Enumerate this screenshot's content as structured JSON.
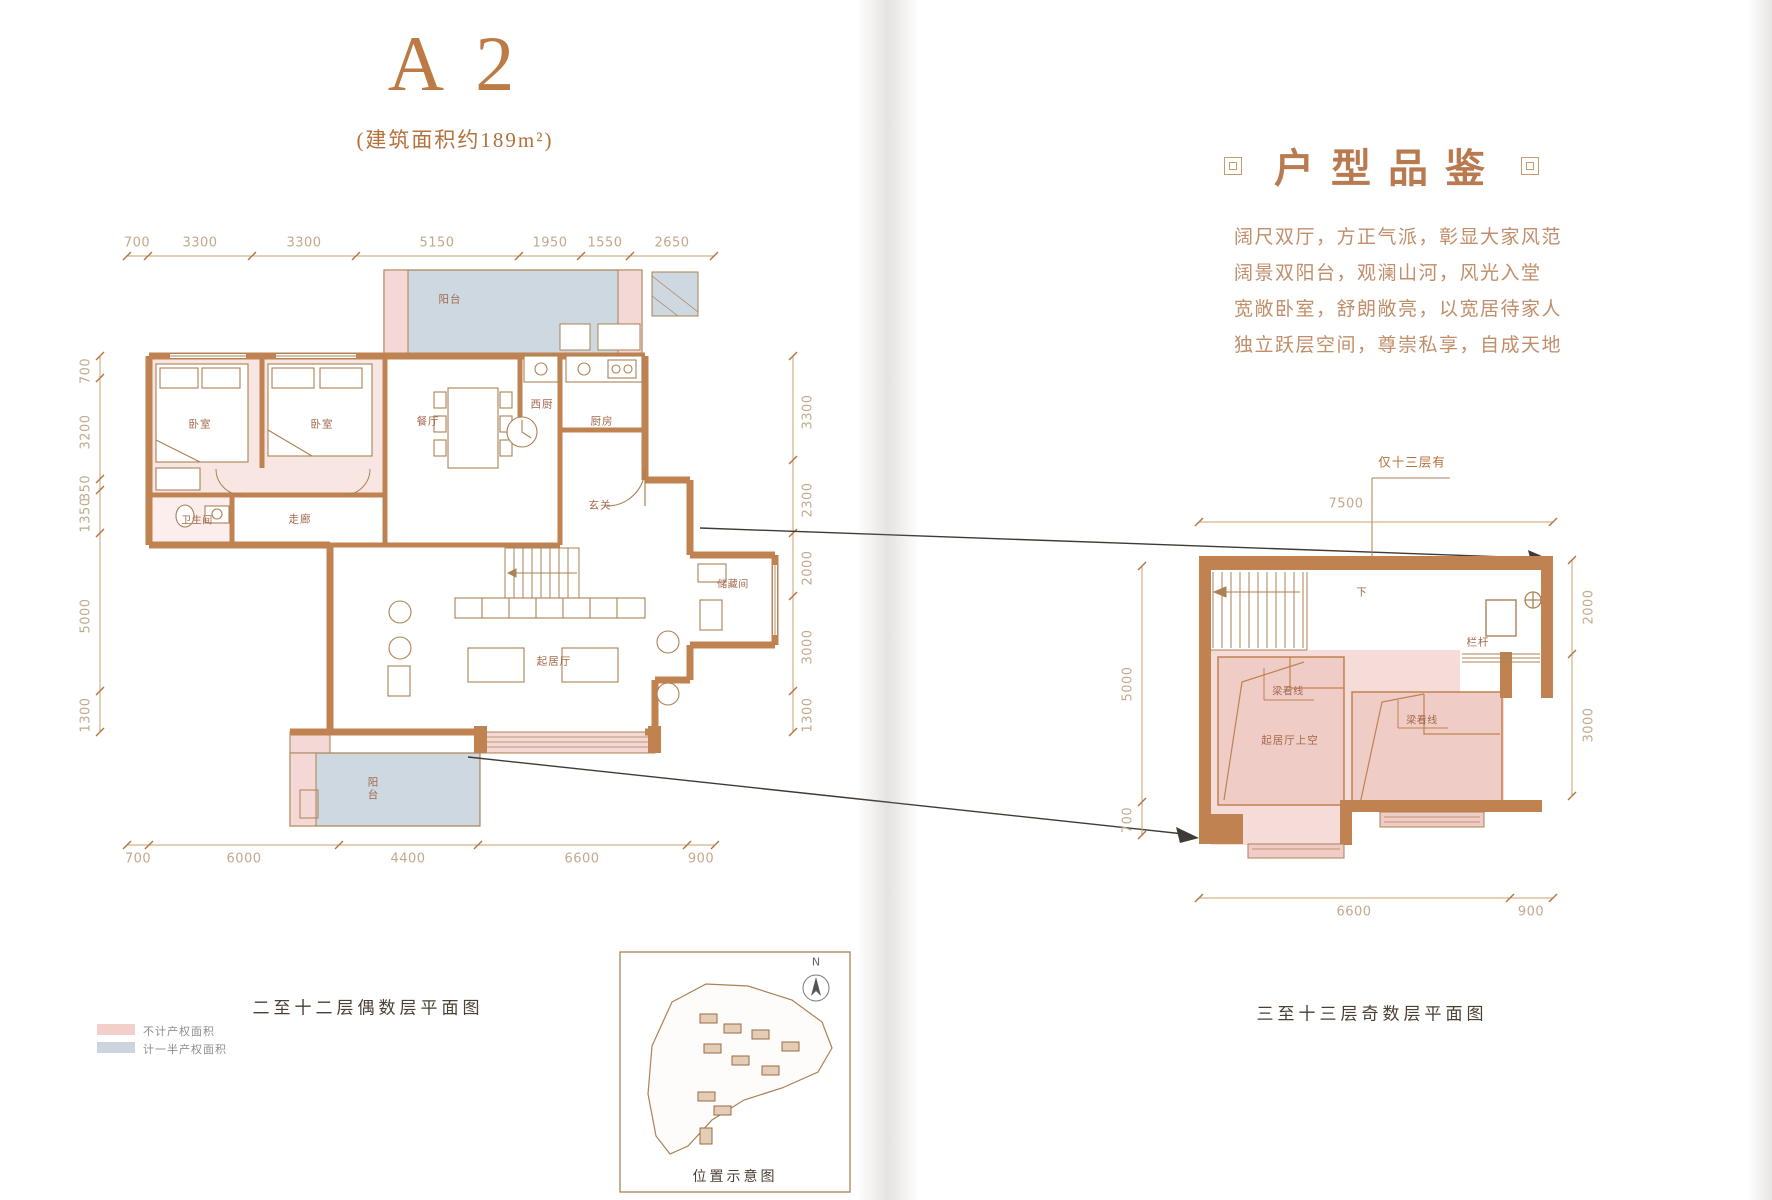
{
  "page": {
    "title": "A 2",
    "subtitle": "(建筑面积约189m²)"
  },
  "detail": {
    "heading": "户型品鉴",
    "lines": [
      "阔尺双厅，方正气派，彰显大家风范",
      "阔景双阳台，观澜山河，风光入堂",
      "宽敞卧室，舒朗敞亮，以宽居待家人",
      "独立跃层空间，尊崇私享，自成天地"
    ]
  },
  "left_plan": {
    "caption": "二至十二层偶数层平面图",
    "dims_top": [
      "700",
      "3300",
      "3300",
      "5150",
      "1950",
      "1550",
      "2650"
    ],
    "dims_left": [
      "700",
      "3200",
      "350",
      "1350",
      "5000",
      "1300"
    ],
    "dims_right": [
      "3300",
      "2300",
      "2000",
      "3000",
      "1300"
    ],
    "dims_bottom": [
      "700",
      "6000",
      "4400",
      "6600",
      "900"
    ],
    "rooms": {
      "balcony_top": "阳台",
      "bedroom_1": "卧室",
      "bedroom_2": "卧室",
      "dining": "餐厅",
      "west_kitchen": "西厨",
      "kitchen": "厨房",
      "bathroom": "卫生间",
      "corridor": "走廊",
      "foyer": "玄关",
      "storage": "储藏间",
      "living": "起居厅",
      "balcony_bottom": "阳台"
    }
  },
  "right_plan": {
    "caption": "三至十三层奇数层平面图",
    "note_top": "仅十三层有",
    "dim_top": "7500",
    "dim_left_upper": "5000",
    "dim_left_lower": "700",
    "dim_right_upper": "2000",
    "dim_right_lower": "3000",
    "dim_bottom_left": "6600",
    "dim_bottom_right": "900",
    "label_down": "下",
    "label_railing": "栏杆",
    "label_beam_1": "梁看线",
    "label_beam_2": "梁看线",
    "label_void": "起居厅上空"
  },
  "legend": {
    "not_counted": "不计产权面积",
    "half_counted": "计一半产权面积"
  },
  "map": {
    "caption": "位置示意图",
    "north": "N"
  },
  "colors": {
    "accent": "#b5713c",
    "wall": "#bf8250",
    "area_excluded_pink": "#f2cfcb",
    "area_half_blue": "#ccd5dd",
    "room_fill_pink": "#f8e6e3",
    "dim_text": "#c0a98c",
    "room_text": "#a3684b"
  }
}
